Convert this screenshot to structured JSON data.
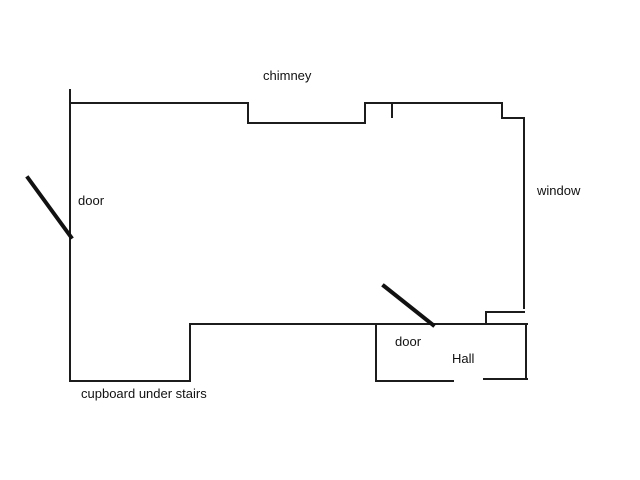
{
  "canvas": {
    "width": 640,
    "height": 480,
    "background_color": "#ffffff",
    "wall_color": "#1c1c1c",
    "door_swing_color": "#111111",
    "text_color": "#111111"
  },
  "labels": {
    "chimney": "chimney",
    "door_left": "door",
    "window": "window",
    "door_hall": "door",
    "hall": "Hall",
    "cupboard": "cupboard under stairs"
  },
  "floorplan": {
    "walls": [
      {
        "name": "left-wall",
        "x1": 70,
        "y1": 90,
        "x2": 70,
        "y2": 381
      },
      {
        "name": "top-wall-left",
        "x1": 70,
        "y1": 103,
        "x2": 248,
        "y2": 103
      },
      {
        "name": "chimney-step-left",
        "x1": 248,
        "y1": 103,
        "x2": 248,
        "y2": 123
      },
      {
        "name": "chimney-recess",
        "x1": 248,
        "y1": 123,
        "x2": 365,
        "y2": 123
      },
      {
        "name": "chimney-step-right",
        "x1": 365,
        "y1": 123,
        "x2": 365,
        "y2": 103
      },
      {
        "name": "top-wall-right",
        "x1": 365,
        "y1": 103,
        "x2": 502,
        "y2": 103
      },
      {
        "name": "top-wall-tick",
        "x1": 392,
        "y1": 103,
        "x2": 392,
        "y2": 117
      },
      {
        "name": "top-right-step-down",
        "x1": 502,
        "y1": 103,
        "x2": 502,
        "y2": 118
      },
      {
        "name": "top-right-ledge",
        "x1": 502,
        "y1": 118,
        "x2": 524,
        "y2": 118
      },
      {
        "name": "window-wall",
        "x1": 524,
        "y1": 118,
        "x2": 524,
        "y2": 308
      },
      {
        "name": "window-notch-top",
        "x1": 486,
        "y1": 312,
        "x2": 524,
        "y2": 312
      },
      {
        "name": "window-notch-side",
        "x1": 486,
        "y1": 312,
        "x2": 486,
        "y2": 324
      },
      {
        "name": "middle-wall",
        "x1": 190,
        "y1": 324,
        "x2": 527,
        "y2": 324
      },
      {
        "name": "cupboard-step",
        "x1": 190,
        "y1": 324,
        "x2": 190,
        "y2": 381
      },
      {
        "name": "cupboard-bottom",
        "x1": 70,
        "y1": 381,
        "x2": 190,
        "y2": 381
      },
      {
        "name": "hall-left-wall",
        "x1": 376,
        "y1": 324,
        "x2": 376,
        "y2": 381
      },
      {
        "name": "hall-bottom-left",
        "x1": 376,
        "y1": 381,
        "x2": 453,
        "y2": 381
      },
      {
        "name": "hall-bottom-right",
        "x1": 484,
        "y1": 379,
        "x2": 527,
        "y2": 379
      },
      {
        "name": "hall-right-wall",
        "x1": 526,
        "y1": 324,
        "x2": 526,
        "y2": 379
      }
    ],
    "door_swings": [
      {
        "name": "door-swing-left",
        "x1": 28,
        "y1": 178,
        "x2": 71,
        "y2": 237
      },
      {
        "name": "door-swing-hall",
        "x1": 384,
        "y1": 286,
        "x2": 433,
        "y2": 325
      }
    ],
    "wall_stroke_width": 2,
    "door_stroke_width": 4
  }
}
